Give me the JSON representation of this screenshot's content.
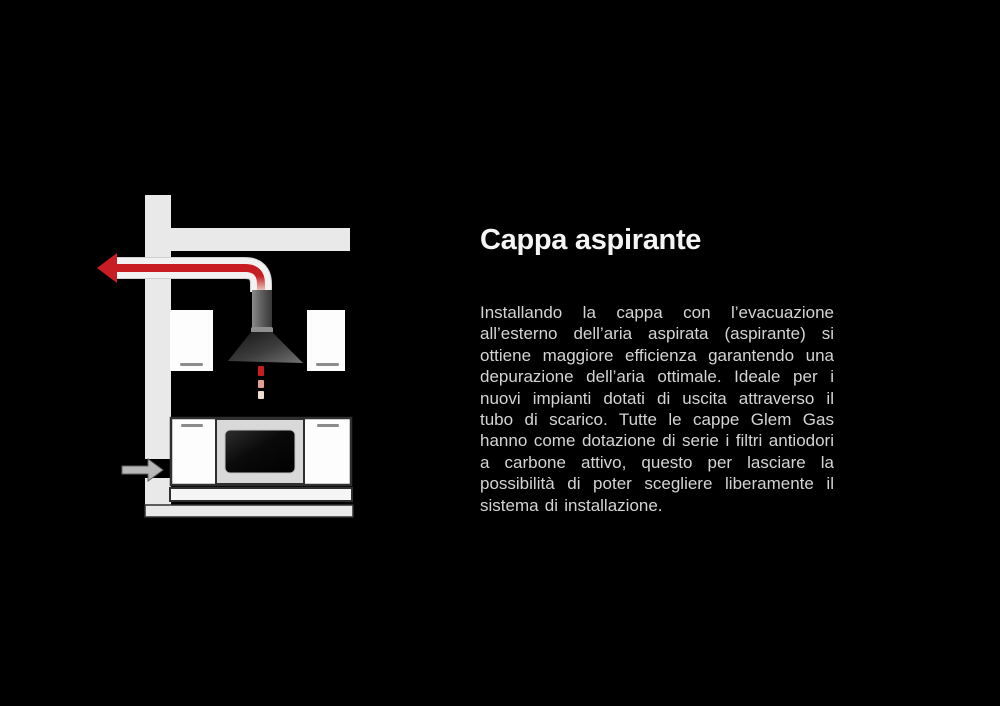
{
  "colors": {
    "background": "#000000",
    "accent_red": "#c81e23",
    "duct_white": "#f2f2f2",
    "structure_gray": "#e9e9e9",
    "cabinet_white": "#fdfdfd",
    "outline_dark": "#2f2f2f",
    "oven_panel_gray": "#d9d9d9",
    "handle_gray": "#8c8c8c",
    "intake_gray": "#b8b8b8",
    "title_color": "#f4f4f4",
    "body_color": "#d4d4d4"
  },
  "content": {
    "title": "Cappa aspirante",
    "body": "Installando la cappa con l’evacuazione all’esterno dell’aria aspirata (aspirante) si ottiene maggiore efficienza garantendo una depurazione dell’aria ottimale. Ideale per i nuovi impianti dotati di uscita attraverso il tubo di scarico. Tutte le cappe Glem Gas hanno come dotazione di serie i filtri antiodori a carbone attivo, questo per lasciare la possibilità di poter scegliere liberamente il sistema di installazione."
  }
}
